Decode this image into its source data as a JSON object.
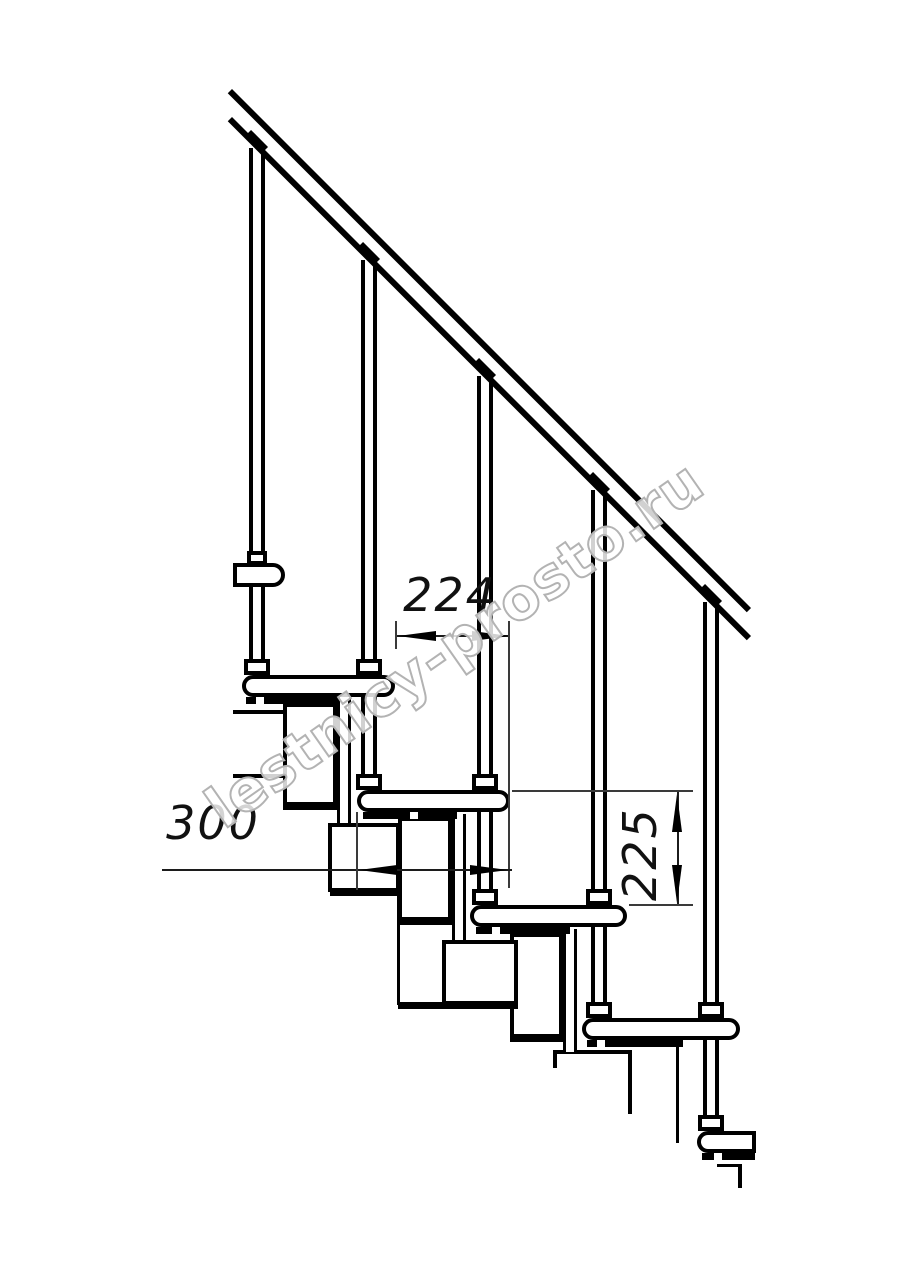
{
  "drawing": {
    "type": "staircase-side-elevation",
    "colors": {
      "line": "#000000",
      "background": "#ffffff",
      "dimension": "#1c1c1c",
      "watermark": "#b3b3b3"
    }
  },
  "dimensions": {
    "step_run": "224",
    "tread_depth": "300",
    "step_rise": "225"
  },
  "watermark": {
    "text": "lestnicy-prosto.ru"
  }
}
